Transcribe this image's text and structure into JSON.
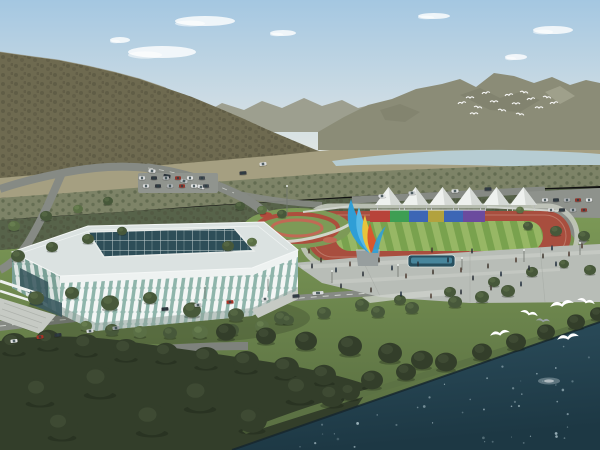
{
  "scene": {
    "description": "Aerial architectural rendering of a lakeside sports complex: a white ribbed gymnasium with a glass skylight roof, a red running track with a striped green infield, a row of white event tents behind a multicolored banner wall, a twisting blue-yellow-red flame sculpture, a pedestrian plaza, tree-lined roads with cars, forested mountains with a river behind, a flock of white birds over the far ridge, and white egrets flying above a dark lake in the foreground"
  },
  "colors": {
    "sky_top": "#a4c7e1",
    "sky_mid": "#cfdde4",
    "sky_horizon": "#e8eae2",
    "cloud": "#ffffff",
    "ridge_far": "#9a9b8a",
    "mountain_right": "#8b8c77",
    "mountain_right_dark": "#6e705c",
    "mountain_scree": "#b9b8a4",
    "mountain_left": "#6e6a50",
    "mountain_ridge_light": "#8d8668",
    "haze_forest": "#a59f81",
    "river": "#b6ccd2",
    "orchard": "#7d8367",
    "forest_band": "#57634a",
    "lawn": "#7d9a57",
    "lawn_deep": "#55693f",
    "track": "#a84e3e",
    "track_lane": "#c08270",
    "field_light": "#97b765",
    "field_dark": "#79a24e",
    "path_light": "#c3c8bd",
    "tent": "#eef1ee",
    "tent_shade": "#d5d9d5",
    "flower": "#b04a3c",
    "flower_light": "#c06a55",
    "sculpture_blue": "#2f9ed6",
    "sculpture_blue_light": "#57b9e6",
    "sculpture_yellow": "#e8c43c",
    "sculpture_red": "#d8582e",
    "pedestal": "#979e9e",
    "stadium_roof": "#dbe2e1",
    "stadium_rib": "#f3f6f5",
    "stadium_glass": "#8fb5ab",
    "stadium_glass_shade": "#7aa096",
    "stadium_rib_shade": "#dde4e2",
    "skylight": "#2e4e58",
    "skylight_grid": "#c5d2d2",
    "stairs": "#c6cac4",
    "road": "#868a84",
    "road_dash": "#d9dcd7",
    "plaza": "#b8bdb7",
    "plaza_light": "#cdd1cb",
    "pool_rim": "#27505f",
    "pool_water": "#4d8ca3",
    "forest_dark": "#333e2a",
    "bank": "#5c7244",
    "water_top": "#2d4f5e",
    "water_bottom": "#1d3844",
    "sparkle": "#cfe3ea",
    "bird": "#ffffff",
    "bird_grey": "#9aa2a4",
    "tree_shades": [
      "#333e2a",
      "#47583a",
      "#5a6f45"
    ],
    "tree_highlights": [
      "#46543a",
      "#5d7049",
      "#6f8756"
    ]
  },
  "objects": {
    "banner_panels": [
      "#b8433a",
      "#3e9e53",
      "#3d66b5",
      "#b2a23e",
      "#3d66b5",
      "#6b4b9e"
    ],
    "tents": {
      "count": 6,
      "x0": 375,
      "step": 27,
      "width": 27,
      "baseY": 205,
      "peakY": 187
    },
    "clouds": [
      [
        205,
        21,
        30,
        5
      ],
      [
        162,
        52,
        34,
        6
      ],
      [
        283,
        33,
        13,
        3
      ],
      [
        553,
        30,
        20,
        4
      ],
      [
        516,
        57,
        11,
        3
      ],
      [
        434,
        16,
        16,
        3
      ],
      [
        120,
        40,
        10,
        3
      ]
    ],
    "trees": [
      [
        36,
        298,
        8,
        1
      ],
      [
        72,
        293,
        7,
        1
      ],
      [
        110,
        303,
        9,
        1
      ],
      [
        150,
        298,
        7,
        1
      ],
      [
        192,
        310,
        9,
        1
      ],
      [
        236,
        315,
        8,
        1
      ],
      [
        282,
        318,
        8,
        1
      ],
      [
        324,
        313,
        7,
        1
      ],
      [
        362,
        305,
        7,
        1
      ],
      [
        400,
        300,
        6,
        1
      ],
      [
        450,
        292,
        6,
        1
      ],
      [
        494,
        282,
        6,
        1
      ],
      [
        532,
        272,
        6,
        1
      ],
      [
        564,
        264,
        5,
        1
      ],
      [
        590,
        270,
        6,
        1
      ],
      [
        455,
        302,
        7,
        1
      ],
      [
        482,
        297,
        7,
        1
      ],
      [
        508,
        291,
        7,
        1
      ],
      [
        412,
        308,
        7,
        1
      ],
      [
        378,
        312,
        7,
        1
      ],
      [
        112,
        330,
        7,
        1
      ],
      [
        140,
        332,
        7,
        2
      ],
      [
        170,
        333,
        7,
        1
      ],
      [
        200,
        332,
        8,
        2
      ],
      [
        232,
        330,
        7,
        1
      ],
      [
        262,
        326,
        7,
        2
      ],
      [
        288,
        320,
        6,
        1
      ],
      [
        86,
        326,
        6,
        2
      ],
      [
        18,
        256,
        7,
        1
      ],
      [
        52,
        247,
        6,
        1
      ],
      [
        88,
        239,
        6,
        1
      ],
      [
        122,
        231,
        5,
        1
      ],
      [
        14,
        226,
        6,
        2
      ],
      [
        46,
        216,
        6,
        1
      ],
      [
        78,
        209,
        5,
        2
      ],
      [
        108,
        201,
        5,
        1
      ],
      [
        240,
        206,
        5,
        1
      ],
      [
        262,
        210,
        5,
        2
      ],
      [
        282,
        214,
        5,
        1
      ],
      [
        228,
        246,
        6,
        1
      ],
      [
        252,
        242,
        5,
        2
      ],
      [
        528,
        226,
        5,
        1
      ],
      [
        556,
        231,
        6,
        1
      ],
      [
        584,
        236,
        6,
        1
      ],
      [
        520,
        210,
        4,
        2
      ],
      [
        14,
        344,
        13,
        0
      ],
      [
        48,
        340,
        12,
        0
      ],
      [
        86,
        345,
        13,
        0
      ],
      [
        126,
        350,
        13,
        0
      ],
      [
        166,
        353,
        12,
        0
      ],
      [
        206,
        358,
        13,
        0
      ],
      [
        246,
        362,
        13,
        0
      ],
      [
        286,
        368,
        13,
        0
      ],
      [
        324,
        375,
        12,
        0
      ],
      [
        226,
        332,
        10,
        0
      ],
      [
        266,
        336,
        10,
        0
      ],
      [
        306,
        341,
        11,
        0
      ],
      [
        350,
        346,
        12,
        0
      ],
      [
        390,
        353,
        12,
        0
      ],
      [
        422,
        360,
        11,
        0
      ],
      [
        300,
        390,
        16,
        0
      ],
      [
        200,
        396,
        18,
        0
      ],
      [
        100,
        382,
        18,
        0
      ],
      [
        40,
        392,
        16,
        0
      ],
      [
        152,
        420,
        18,
        0
      ],
      [
        62,
        426,
        16,
        0
      ],
      [
        252,
        420,
        15,
        0
      ],
      [
        332,
        396,
        13,
        0
      ],
      [
        372,
        380,
        11,
        0
      ],
      [
        406,
        372,
        10,
        0
      ],
      [
        446,
        362,
        11,
        0
      ],
      [
        482,
        352,
        10,
        0
      ],
      [
        516,
        342,
        10,
        0
      ],
      [
        546,
        332,
        9,
        0
      ],
      [
        576,
        322,
        9,
        0
      ],
      [
        598,
        314,
        8,
        0
      ],
      [
        350,
        392,
        10,
        0
      ]
    ],
    "cars": [
      [
        14,
        341,
        "#e2e4e4",
        -7
      ],
      [
        40,
        337,
        "#a83226",
        -7
      ],
      [
        58,
        335,
        "#2c323a",
        -7
      ],
      [
        90,
        331,
        "#d8dadc",
        -7
      ],
      [
        116,
        328,
        "#9aa0a4",
        -7
      ],
      [
        165,
        309,
        "#2c323a",
        -5
      ],
      [
        198,
        305,
        "#c3c7c9",
        -5
      ],
      [
        230,
        302,
        "#a83226",
        -5
      ],
      [
        265,
        299,
        "#e4e6e6",
        -5
      ],
      [
        296,
        296,
        "#353b44",
        -5
      ],
      [
        318,
        293,
        "#d8dadc",
        -4,
        11
      ],
      [
        152,
        171,
        "#dfe1e1",
        4
      ],
      [
        167,
        176,
        "#2f353d",
        9
      ],
      [
        184,
        181,
        "#b9bdbf",
        13
      ],
      [
        201,
        187,
        "#e0e2e2",
        16
      ],
      [
        243,
        173,
        "#333941",
        -4
      ],
      [
        263,
        164,
        "#d9dbdb",
        -8
      ],
      [
        382,
        196,
        "#e0e2e2",
        -2
      ],
      [
        412,
        193,
        "#c9cdcf",
        -2
      ],
      [
        455,
        191,
        "#dfe1e1",
        -2
      ],
      [
        488,
        189,
        "#343a42",
        -2
      ]
    ],
    "car_palette": [
      "#d9dbdc",
      "#32383f",
      "#aeb2b5",
      "#93352b",
      "#e3e5e5",
      "#42484f"
    ],
    "parking_rows": [
      {
        "x": 142,
        "y": 178,
        "n": 6,
        "step": 12,
        "angle": 0
      },
      {
        "x": 146,
        "y": 186,
        "n": 6,
        "step": 12,
        "angle": 0
      },
      {
        "x": 545,
        "y": 200,
        "n": 5,
        "step": 11,
        "angle": -3
      },
      {
        "x": 551,
        "y": 210,
        "n": 4,
        "step": 11,
        "angle": -3
      }
    ],
    "people_palette": [
      "#2b3138",
      "#423a31",
      "#22303e",
      "#513f35"
    ],
    "people": [
      [
        312,
        268
      ],
      [
        321,
        262
      ],
      [
        336,
        272
      ],
      [
        350,
        266
      ],
      [
        363,
        276
      ],
      [
        379,
        262
      ],
      [
        392,
        270
      ],
      [
        406,
        278
      ],
      [
        418,
        266
      ],
      [
        433,
        274
      ],
      [
        448,
        262
      ],
      [
        461,
        272
      ],
      [
        473,
        280
      ],
      [
        488,
        268
      ],
      [
        501,
        276
      ],
      [
        516,
        262
      ],
      [
        529,
        270
      ],
      [
        543,
        258
      ],
      [
        556,
        266
      ],
      [
        569,
        256
      ],
      [
        341,
        288
      ],
      [
        371,
        292
      ],
      [
        401,
        296
      ],
      [
        431,
        298
      ],
      [
        461,
        294
      ],
      [
        491,
        290
      ],
      [
        521,
        286
      ],
      [
        309,
        253
      ],
      [
        472,
        253
      ],
      [
        432,
        252
      ],
      [
        552,
        250
      ],
      [
        582,
        248
      ]
    ],
    "light_poles": [
      [
        287,
        216,
        30
      ],
      [
        140,
        312,
        13
      ],
      [
        205,
        299,
        13
      ],
      [
        268,
        291,
        13
      ],
      [
        332,
        283,
        12
      ],
      [
        398,
        277,
        12
      ],
      [
        462,
        270,
        12
      ],
      [
        524,
        262,
        12
      ],
      [
        580,
        255,
        12
      ]
    ],
    "flock": [
      [
        458,
        104
      ],
      [
        466,
        98
      ],
      [
        474,
        107
      ],
      [
        482,
        94
      ],
      [
        490,
        102
      ],
      [
        498,
        110
      ],
      [
        505,
        96
      ],
      [
        512,
        104
      ],
      [
        520,
        92
      ],
      [
        527,
        100
      ],
      [
        535,
        108
      ],
      [
        543,
        97
      ],
      [
        550,
        104
      ],
      [
        470,
        114
      ],
      [
        516,
        114
      ]
    ],
    "gulls": [
      [
        500,
        334,
        10,
        0
      ],
      [
        529,
        314,
        9,
        1
      ],
      [
        562,
        305,
        12,
        0
      ],
      [
        586,
        302,
        9,
        1
      ],
      [
        568,
        338,
        11,
        0
      ],
      [
        543,
        321,
        7,
        2
      ]
    ],
    "sparkle_count": 46
  }
}
